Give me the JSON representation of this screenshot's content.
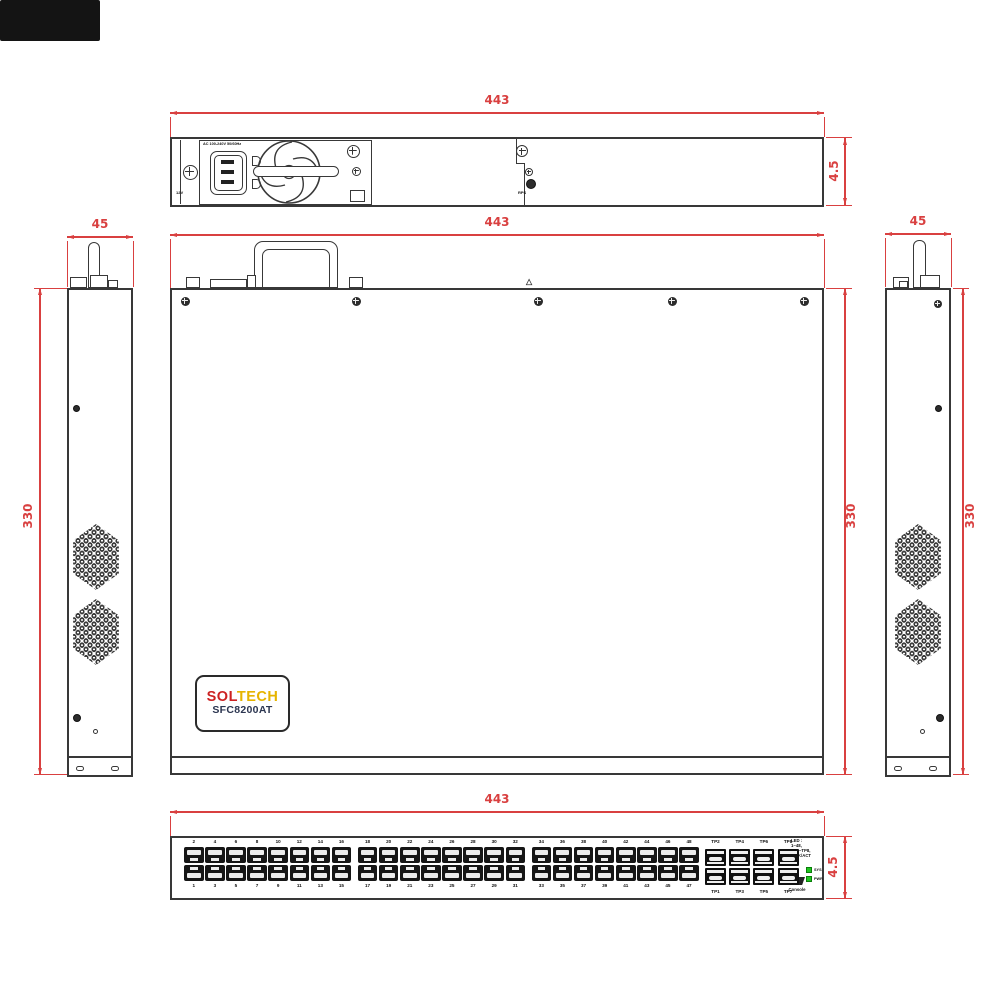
{
  "colors": {
    "line": "#383838",
    "dimension_red": "#d94040",
    "led_green": "#1ec41e",
    "logo_sol_red": "#cc2222",
    "logo_tech_yellow": "#e6b400"
  },
  "dims": {
    "rear_width": "443",
    "rear_height": "4.5",
    "top_width": "443",
    "top_depth": "330",
    "left_side_width": "45",
    "left_side_depth": "330",
    "right_side_width": "45",
    "right_side_depth": "330",
    "front_width": "443",
    "front_height": "4.5"
  },
  "rear": {
    "psu_label": "AC 100-240V 50/60Hz",
    "corner_label": "12V",
    "slot_label": "RPS"
  },
  "logo": {
    "sol": "SOL",
    "tech": "TECH",
    "model": "SFC8200AT"
  },
  "front": {
    "port_numbers_top": [
      "2",
      "4",
      "6",
      "8",
      "10",
      "12",
      "14",
      "16",
      "18",
      "20",
      "22",
      "24",
      "26",
      "28",
      "30",
      "32",
      "34",
      "36",
      "38",
      "40",
      "42",
      "44",
      "46",
      "48"
    ],
    "port_numbers_bottom": [
      "1",
      "3",
      "5",
      "7",
      "9",
      "11",
      "13",
      "15",
      "17",
      "19",
      "21",
      "23",
      "25",
      "27",
      "29",
      "31",
      "33",
      "35",
      "37",
      "39",
      "41",
      "43",
      "45",
      "47"
    ],
    "sfp_labels_top": [
      "TP2",
      "TP4",
      "TP6",
      "TP8"
    ],
    "sfp_labels_bottom": [
      "TP1",
      "TP3",
      "TP5",
      "TP7"
    ],
    "console_label": "Console",
    "legend_lines": [
      "LED :",
      "1~48,",
      "TP1~TP8,",
      "LINK/ACT"
    ],
    "led_labels": [
      "SYS",
      "PWR"
    ]
  }
}
